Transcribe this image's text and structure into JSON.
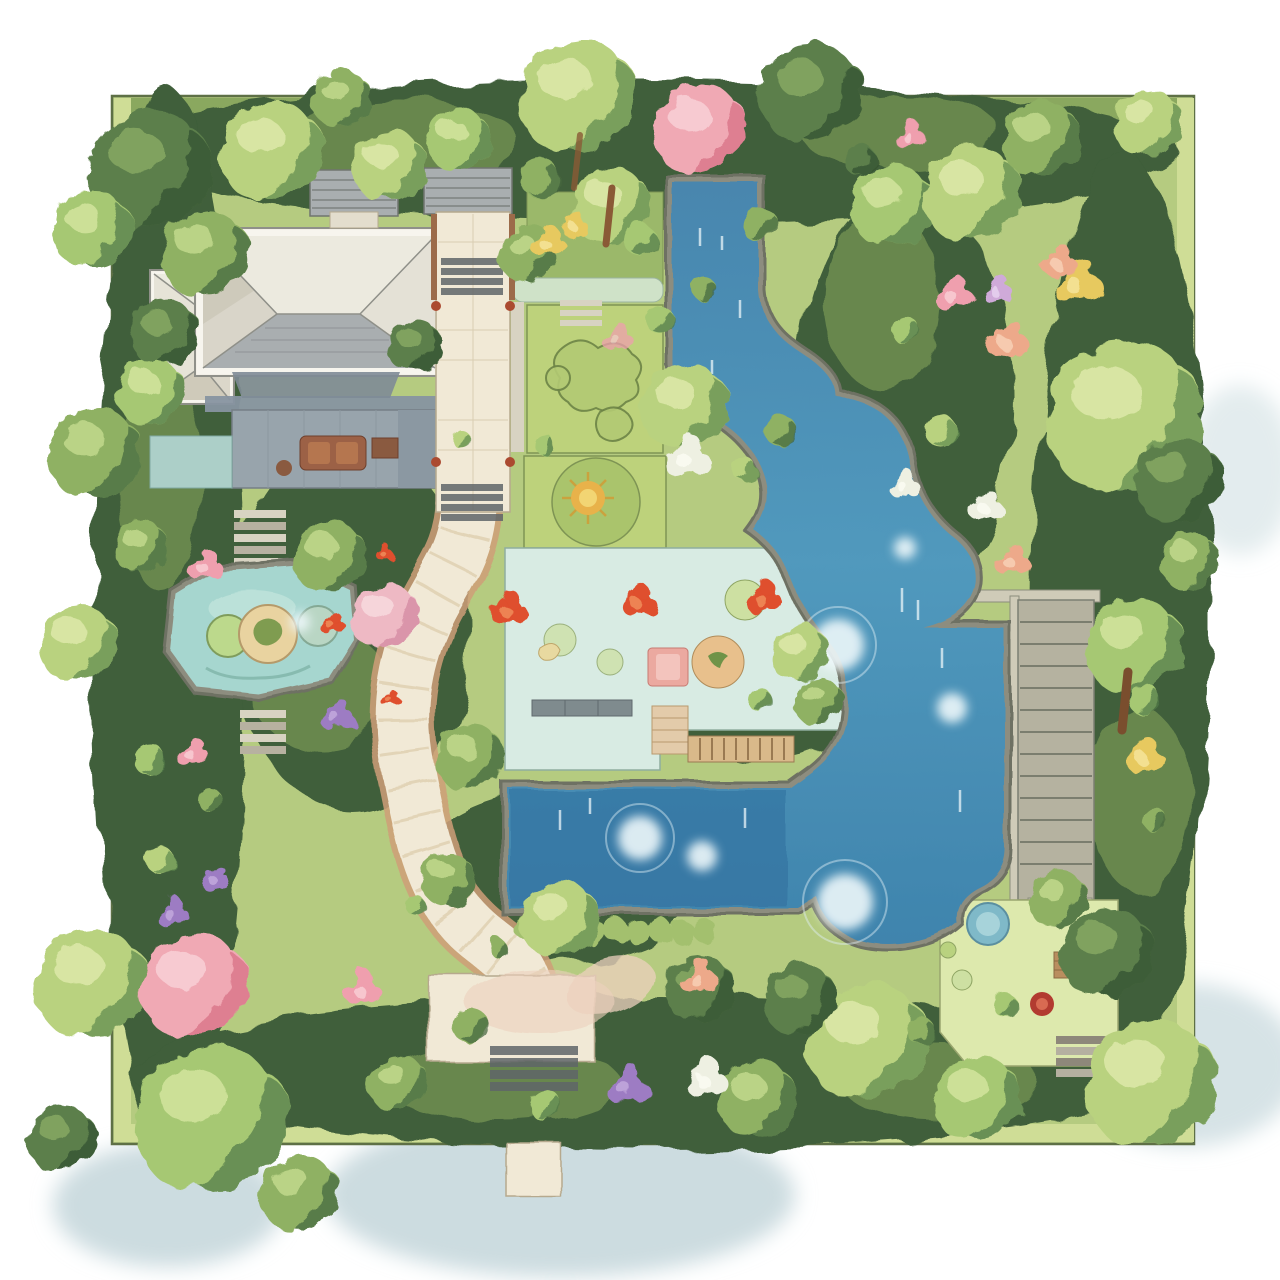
{
  "scene": {
    "type": "watercolor-garden-landscape-plan",
    "view": "top-down",
    "canvas": {
      "width": 1280,
      "height": 1280,
      "background": "#ffffff"
    }
  },
  "features": [
    {
      "id": "house",
      "label": "House with cream hip roof and rear deck"
    },
    {
      "id": "garden-sheds",
      "label": "Twin gray garden sheds"
    },
    {
      "id": "entry-walkway",
      "label": "Stone entry walkway with steps"
    },
    {
      "id": "stream-pond",
      "label": "Winding blue stream pond"
    },
    {
      "id": "lower-pool",
      "label": "Rectangular lower pool"
    },
    {
      "id": "lily-pond",
      "label": "Small aqua lily pond"
    },
    {
      "id": "garden-path",
      "label": "Winding cream garden path"
    },
    {
      "id": "central-patio",
      "label": "Central aqua patio garden"
    },
    {
      "id": "parterre-garden",
      "label": "Parterre lawn and vegetable beds"
    },
    {
      "id": "stone-stairs",
      "label": "Stone stair walkway"
    },
    {
      "id": "corner-patio",
      "label": "Corner patio with round table"
    },
    {
      "id": "plaza-steps",
      "label": "Bottom plaza with steps"
    },
    {
      "id": "boardwalk",
      "label": "Wooden boardwalk"
    },
    {
      "id": "trees",
      "label": "Watercolor trees and shrubs"
    },
    {
      "id": "flowers",
      "label": "Flowering shrubs"
    },
    {
      "id": "plot",
      "label": "Square garden plot"
    }
  ],
  "palette": {
    "paper": "#ffffff",
    "plotGround": "#b5cb80",
    "plotBand": "#cfdd96",
    "plotTopBand": "#83a259",
    "plotLine": "#5e7046",
    "bedDark": "#3f5e3a",
    "bedMid": "#6d8c50",
    "lawn": "#bdd27b",
    "lawnLine": "#7e9454",
    "hedgePale": "#cfe2c8",
    "aquaPatio": "#d8ebe3",
    "patioLine": "#8fae9f",
    "rightPatio": "#dde9ad",
    "waterRim": "#8d8d7f",
    "waterRimDark": "#6e7163",
    "water1": "#4886ae",
    "water2": "#5199bd",
    "water3": "#3f84ad",
    "poolDeep": "#2f6d9c",
    "pondAqua": "#a6d6cf",
    "sparkle": "#edf7fa",
    "pathCream": "#f1e9d6",
    "pathEdge": "#cf9e78",
    "plazaPink": "#ecd0bd",
    "stone": "#d8d3c2",
    "stoneDark": "#8e9087",
    "stepDark": "#5f6568",
    "stairFill": "#b5b2a0",
    "wallLight": "#cfcbb8",
    "roofCream": "#efece3",
    "roofGray": "#a9aeb0",
    "porchGray": "#8793a0",
    "deckGray": "#98a4ac",
    "tealPatio": "#accfc8",
    "wood": "#b98e5f",
    "woodDark": "#9c6b4a",
    "sofaBrown": "#9c6146",
    "tableBlue": "#7fb9c8",
    "potRed": "#b23b30",
    "wash": "#ccdce0",
    "treeA": "#b9d27f",
    "treeAS": "#5f8a4f",
    "treeAL": "#dde9a9",
    "treeB": "#8fb164",
    "treeBS": "#44663f",
    "treeBL": "#c2d98c",
    "treeC": "#a6c873",
    "treeCS": "#527a49",
    "treeCL": "#d2e49e",
    "treeD": "#5c7f4c",
    "treeDS": "#33512f",
    "treeDL": "#86a862",
    "pinkTree": "#f0a9b4",
    "pinkTreeS": "#d76f84",
    "pinkTreeL": "#f8d0d6",
    "flRed": "#df4f2d",
    "flRedL": "#f08c5a",
    "flPink": "#ef9fae",
    "flPinkL": "#f8cdd3",
    "flSalmon": "#eda98a",
    "flSalmonL": "#f7d0b5",
    "flYellow": "#e7c95e",
    "flYellowL": "#f5e49a",
    "flPurple": "#9d7cc3",
    "flPurpleL": "#c3a9dd",
    "flWhite": "#eef0e2",
    "flWhiteL": "#fafbf2"
  }
}
